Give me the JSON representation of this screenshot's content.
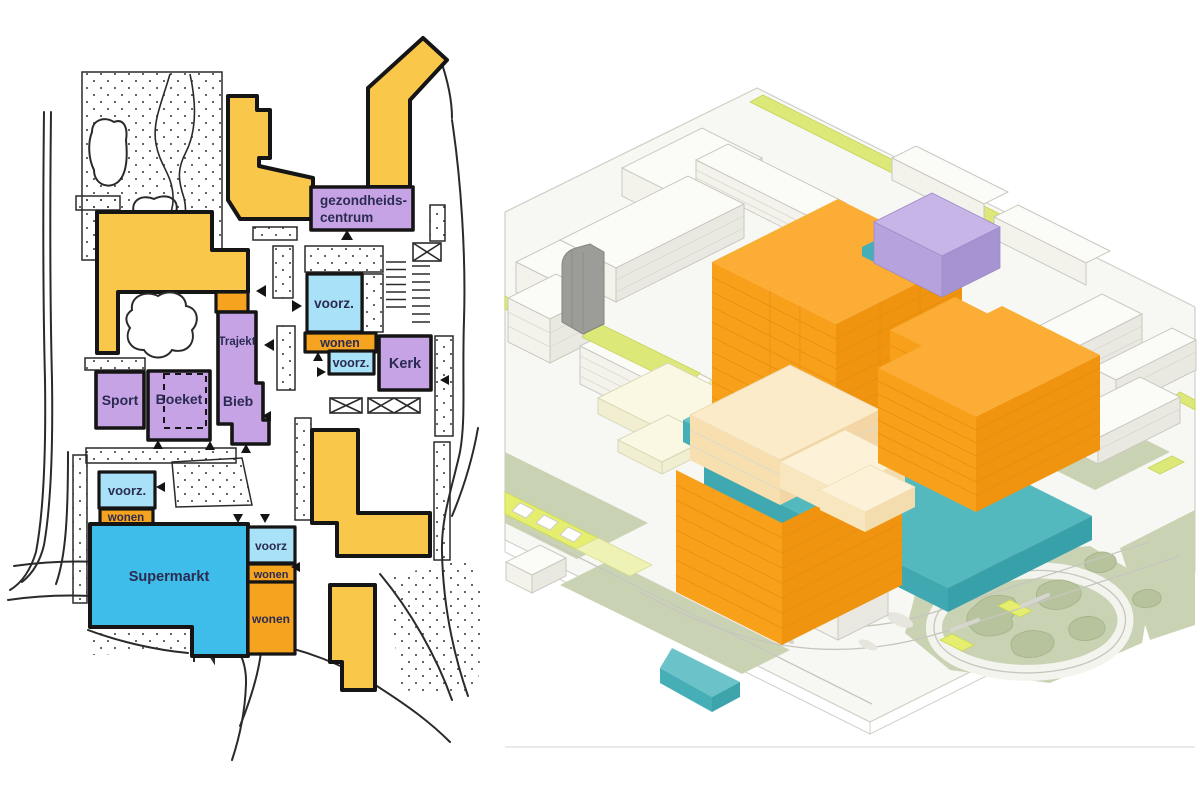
{
  "palette": {
    "yellow": "#F9C84B",
    "orange": "#F6A41F",
    "purple": "#C6A3E5",
    "light_blue": "#A9E1F8",
    "super_blue": "#3EBDEB",
    "ink": "#1A1A1A",
    "label": "#2B2B52",
    "axon_orange": "#F9A01B",
    "axon_orange_top": "#FBAD35",
    "axon_orange_dark": "#F0940F",
    "axon_teal": "#53B9BF",
    "axon_purple": "#C7B5E8",
    "axon_cream": "#FCEBC8",
    "axon_lime": "#DCE878",
    "axon_sage": "#C9D3B3",
    "axon_gray": "#9C9C98"
  },
  "plan": {
    "labels": {
      "gc1": "gezondheids-",
      "gc2": "centrum",
      "voorz_top": "voorz.",
      "wonen_top": "wonen",
      "voorz_mid": "voorz.",
      "kerk": "Kerk",
      "trajekt": "Trajekt",
      "sport": "Sport",
      "boeket": "Boeket",
      "bieb": "Bieb",
      "voorz_left": "voorz.",
      "wonen_left": "wonen",
      "supermarkt": "Supermarkt",
      "voorz_right": "voorz",
      "wonen_right_small": "wonen",
      "wonen_right_large": "wonen"
    }
  }
}
